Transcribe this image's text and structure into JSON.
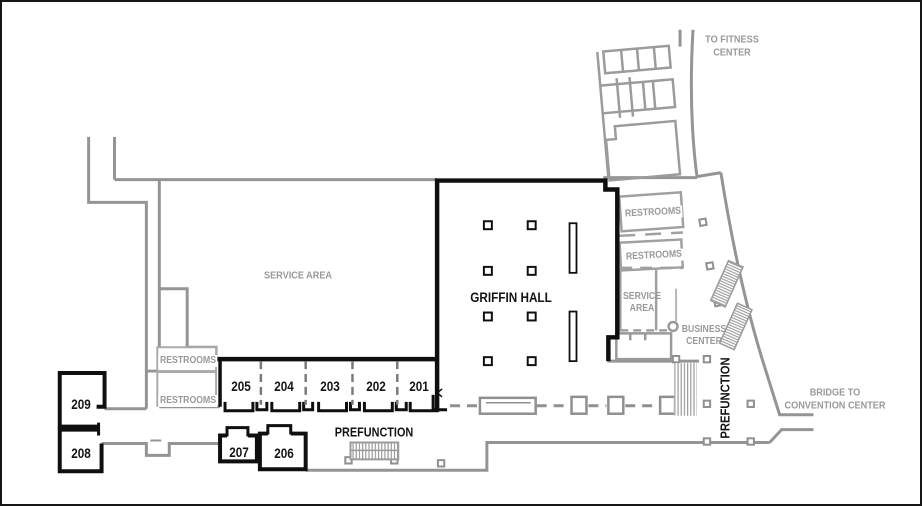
{
  "colors": {
    "wall_black": "#0f0f0f",
    "wall_gray": "#949494",
    "wall_light_gray": "#aaaaaa",
    "label_gray": "#999999",
    "label_black": "#141414",
    "background": "#ffffff"
  },
  "rooms": {
    "r201": "201",
    "r202": "202",
    "r203": "203",
    "r204": "204",
    "r205": "205",
    "r206": "206",
    "r207": "207",
    "r208": "208",
    "r209": "209"
  },
  "labels": {
    "griffin_hall": "GRIFFIN HALL",
    "service_area_left": "SERVICE AREA",
    "restrooms": "RESTROOMS",
    "service_right_line1": "SERVICE",
    "service_right_line2": "AREA",
    "business_line1": "BUSINESS",
    "business_line2": "CENTER",
    "prefunction": "PREFUNCTION",
    "fitness_line1": "TO FITNESS",
    "fitness_line2": "CENTER",
    "bridge_line1": "BRIDGE TO",
    "bridge_line2": "CONVENTION CENTER"
  }
}
